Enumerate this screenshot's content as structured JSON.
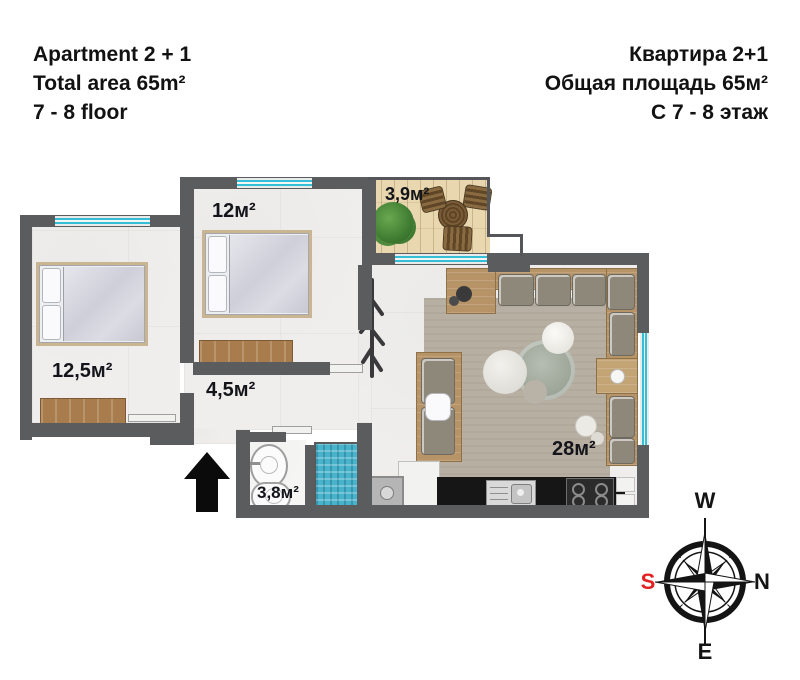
{
  "title_left": {
    "line1": "Apartment 2 + 1",
    "line2": "Total area 65m²",
    "line3": "7 - 8 floor"
  },
  "title_right": {
    "line1": "Квартира 2+1",
    "line2": "Общая площадь 65м²",
    "line3": "С 7 - 8 этаж"
  },
  "floorplan": {
    "rooms": [
      {
        "name": "bedroom-second",
        "area_label": "12м²"
      },
      {
        "name": "balcony",
        "area_label": "3,9м²"
      },
      {
        "name": "bedroom-main",
        "area_label": "12,5м²"
      },
      {
        "name": "hallway",
        "area_label": "4,5м²"
      },
      {
        "name": "bathroom",
        "area_label": "3,8м²"
      },
      {
        "name": "living-room-kitchen",
        "area_label": "28м²"
      }
    ],
    "icons": {
      "entrance": "entrance-arrow-icon",
      "compass": "compass-rose-icon"
    }
  },
  "compass": {
    "top": "W",
    "right": "N",
    "bottom": "E",
    "left": "S"
  },
  "colors": {
    "wall": "#5b5c5e",
    "window": "#35bfd6",
    "shower_tile": "#49b3cc",
    "balcony_floor": "#e9d7af",
    "wood": "#b69468",
    "label_text": "#14151b",
    "compass_south": "#e32121"
  }
}
